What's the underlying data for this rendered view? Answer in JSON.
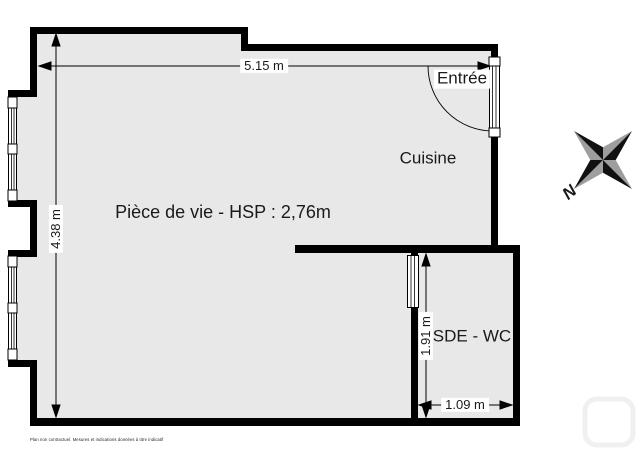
{
  "floorplan": {
    "room_labels": {
      "living": "Pièce de vie - HSP : 2,76m",
      "kitchen": "Cuisine",
      "bathroom": "SDE - WC",
      "entrance": "Entrée"
    },
    "dimensions": {
      "top_width": "5.15 m",
      "left_height": "4.38 m",
      "bathroom_height": "1.91 m",
      "bathroom_width": "1.09 m"
    },
    "compass_label": "N",
    "disclaimer": "Plan non contractuel. Mesures et indications données à titre indicatif",
    "colors": {
      "floor_fill": "#e8e8e8",
      "wall": "#000000",
      "compass_dark": "#111111",
      "compass_light": "#9e9e9e",
      "text": "#1a1a1a"
    }
  }
}
